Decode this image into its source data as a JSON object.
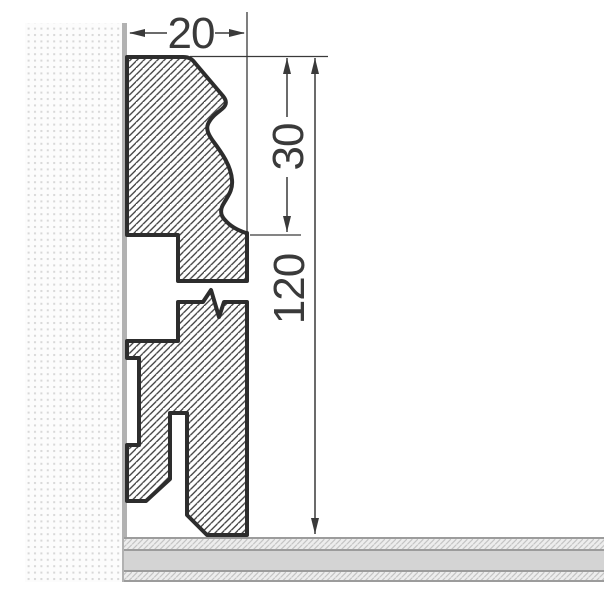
{
  "figure": {
    "labels": {
      "width": "20",
      "upper_section_height": "30",
      "total_height": "120"
    },
    "colors": {
      "outline": "#2d2d2d",
      "hatch_line": "#3c3c3c",
      "dimension": "#3a3a3a",
      "wall_background": "#fcfcfc",
      "wall_dot": "#d8d8d8",
      "wall_strip": "#b2b2b2",
      "floor_border": "#9c9c9c",
      "floor_band": "#d4d4d4",
      "floor_hatch_background": "#ededed",
      "floor_hatch_line": "#c4c4c4"
    }
  }
}
